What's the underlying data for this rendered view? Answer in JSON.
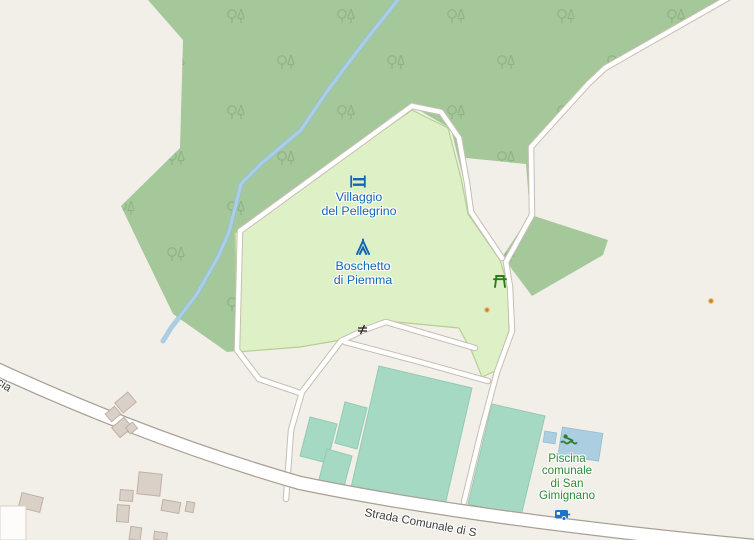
{
  "map_labels": {
    "villaggio": {
      "line1": "Villaggio",
      "line2": "del Pellegrino"
    },
    "boschetto": {
      "line1": "Boschetto",
      "line2": "di Piemma"
    },
    "piscina": {
      "line1": "Piscina",
      "line2": "comunale",
      "line3": "di San",
      "line4": "Gimignano"
    },
    "road_main": "Strada Comunale di S",
    "road_left_fragment": "ucia"
  },
  "colors": {
    "land": "#f2efe9",
    "forest": "#a5c89a",
    "forest_tree_glyph": "#8aaf80",
    "campsite": "#def1c6",
    "campsite_border": "#b5cf92",
    "pitch": "#a5d9c3",
    "pool": "#abcfe0",
    "stream": "#aacee8",
    "road_fill": "#ffffff",
    "road_casing": "#a8a093",
    "track_casing": "#c6bfb1",
    "building": "#d9d0c8",
    "building_border": "#bfb1a2",
    "poi_blue": "#1467b8",
    "poi_green": "#2e8b3a",
    "picnic_green": "#2e7a1e",
    "poi_dot_orange": "#c8811e"
  },
  "icons": {
    "hostel": "hostel-icon",
    "tent": "tent-icon",
    "picnic": "picnic-table-icon",
    "swimmer": "swimmer-icon",
    "caravan": "caravan-icon",
    "gate": "gate-icon",
    "poi_dot": "poi-dot"
  }
}
